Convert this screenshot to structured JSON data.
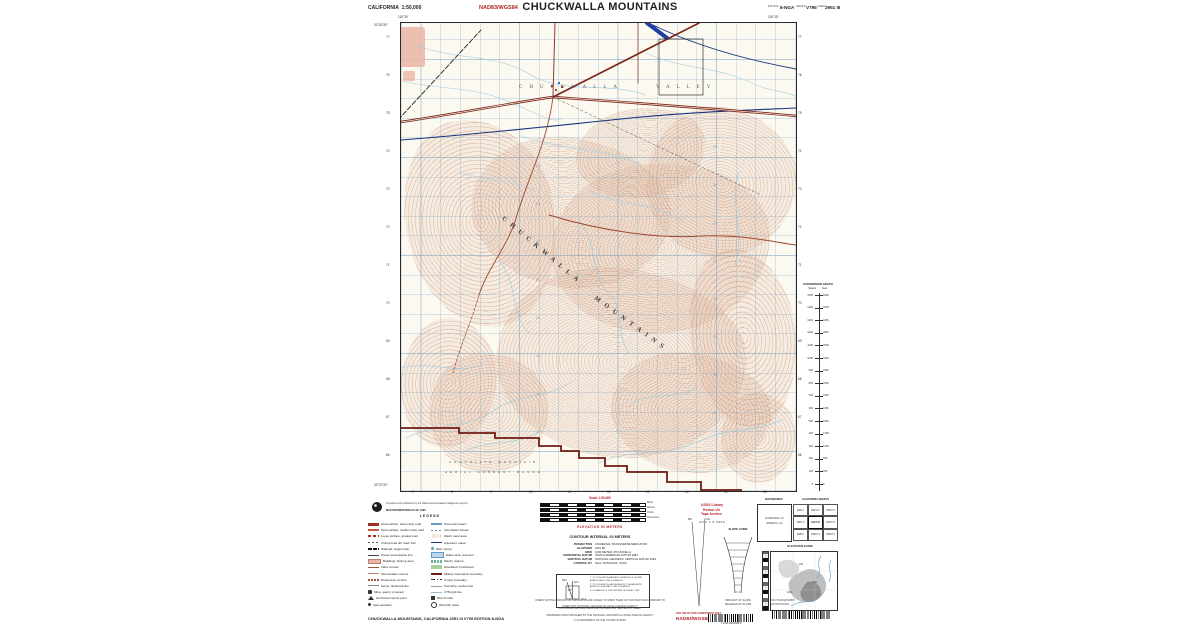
{
  "colors": {
    "accent_red": "#b01f24",
    "road": "#8a3a28",
    "contour": "#b07a5e",
    "water": "#9cc7de",
    "grid_line": "#9db9cc",
    "boundary": "#6e1d12"
  },
  "header": {
    "region": "CALIFORNIA",
    "scale": "1:50,000",
    "datum": "NAD83/WGS84",
    "title": "CHUCKWALLA MOUNTAINS",
    "edition_label": "EDITION",
    "edition": "8-NGA",
    "series_label": "SERIES",
    "series": "V795",
    "sheet_label": "SHEET",
    "sheet": "2951 III"
  },
  "map": {
    "labels": {
      "valley_1": "CHUCKWALLA",
      "valley_2": "VALLEY",
      "range_1": "CHUCKWALLA",
      "range_2": "MOUNTAINS",
      "range_s1": "CHOCOLATE MOUNTAIN",
      "range_s2": "AERIAL GUNNERY RANGE"
    },
    "corners": {
      "tl_lon": "115°30′",
      "tr_lon": "115°15′",
      "tl_lat": "33°52′30″",
      "bl_lat": "33°37′30″"
    },
    "grid": {
      "bottom": [
        "7",
        "8",
        "9",
        "10",
        "11",
        "12",
        "13",
        "14",
        "15",
        "16"
      ],
      "left": [
        "77",
        "76",
        "75",
        "74",
        "73",
        "72",
        "71",
        "70",
        "69",
        "68",
        "67",
        "66"
      ],
      "right": [
        "77",
        "76",
        "75",
        "74",
        "73",
        "72",
        "71",
        "70",
        "69",
        "68",
        "67",
        "66"
      ],
      "interior": [
        {
          "x": 135,
          "y": 142,
          "t": "24"
        },
        {
          "x": 135,
          "y": 180,
          "t": "23"
        },
        {
          "x": 135,
          "y": 218,
          "t": "22"
        },
        {
          "x": 135,
          "y": 256,
          "t": "21"
        },
        {
          "x": 135,
          "y": 294,
          "t": "20"
        },
        {
          "x": 135,
          "y": 332,
          "t": "19"
        },
        {
          "x": 135,
          "y": 370,
          "t": "18"
        },
        {
          "x": 135,
          "y": 408,
          "t": "17"
        },
        {
          "x": 312,
          "y": 123,
          "t": "25"
        },
        {
          "x": 312,
          "y": 161,
          "t": "24"
        },
        {
          "x": 312,
          "y": 199,
          "t": "23"
        },
        {
          "x": 312,
          "y": 237,
          "t": "22"
        },
        {
          "x": 312,
          "y": 275,
          "t": "21"
        },
        {
          "x": 312,
          "y": 313,
          "t": "20"
        },
        {
          "x": 312,
          "y": 351,
          "t": "19"
        },
        {
          "x": 312,
          "y": 389,
          "t": "18"
        }
      ]
    }
  },
  "conversion": {
    "title": "CONVERSION GRAPH",
    "col_m": "Meters",
    "col_f": "Feet",
    "meters": [
      "1500",
      "1400",
      "1300",
      "1200",
      "1100",
      "1000",
      "900",
      "800",
      "700",
      "600",
      "500",
      "400",
      "300",
      "200",
      "100",
      "0"
    ],
    "feet": [
      "4900",
      "4600",
      "4250",
      "3950",
      "3600",
      "3300",
      "2950",
      "2600",
      "2300",
      "1950",
      "1650",
      "1300",
      "1000",
      "650",
      "350",
      "0"
    ]
  },
  "legend": {
    "credit1": "Prepared and published by the National Geospatial-Intelligence Agency",
    "credit2": "MAP INFORMATION AS OF 1995",
    "title": "LEGEND",
    "left": [
      {
        "t": "Hard surface, heavy duty road",
        "s": "sw-road2"
      },
      {
        "t": "Hard surface, medium duty road",
        "s": "sw-road1"
      },
      {
        "t": "Loose surface, graded road",
        "s": "sw-roadl"
      },
      {
        "t": "Unimproved dirt road; trail",
        "s": "sw-dash"
      },
      {
        "t": "Railroad: single track",
        "s": "sw-rail"
      },
      {
        "t": "Power transmission line",
        "s": "sw-power"
      },
      {
        "t": "Buildings; built-up area",
        "s": "sw-pink"
      },
      {
        "t": "Index contour",
        "s": "sw-cbrown2"
      },
      {
        "t": "Intermediate contour",
        "s": "sw-cbrown1"
      },
      {
        "t": "Depression contour",
        "s": "sw-cbrownd"
      },
      {
        "t": "Fence; landmark line",
        "s": "sw-gray"
      },
      {
        "t": "Mine; quarry; prospect",
        "s": "sw-x"
      },
      {
        "t": "Horizontal control point",
        "s": "sw-tri"
      },
      {
        "t": "Spot elevation",
        "s": "sw-dot"
      }
    ],
    "right": [
      {
        "t": "Perennial stream",
        "s": "sw-blue"
      },
      {
        "t": "Intermittent stream",
        "s": "sw-blued"
      },
      {
        "t": "Wash; sand area",
        "s": "sw-sand"
      },
      {
        "t": "Aqueduct; canal",
        "s": "sw-bluet"
      },
      {
        "t": "Well; spring",
        "s": "sw-dotb"
      },
      {
        "t": "Water tank; reservoir",
        "s": "sw-bluebox"
      },
      {
        "t": "Marsh; swamp",
        "s": "sw-marsh"
      },
      {
        "t": "Woodland; brushwood",
        "s": "sw-green"
      },
      {
        "t": "Military reservation boundary",
        "s": "sw-bdry"
      },
      {
        "t": "County boundary",
        "s": "sw-bdry2"
      },
      {
        "t": "Township, section line",
        "s": "sw-sect"
      },
      {
        "t": "UTM grid line",
        "s": "sw-grid"
      },
      {
        "t": "Bench mark",
        "s": "sw-bm"
      },
      {
        "t": "Windmill; tower",
        "s": "sw-wind"
      }
    ]
  },
  "scaleblock": {
    "scale_label": "Scale 1:50,000",
    "bars": [
      "Miles",
      "Meters",
      "Yards",
      "Kilometers"
    ],
    "elevation": "ELEVATION IN METERS",
    "contour": "CONTOUR INTERVAL 20 METERS"
  },
  "specs": [
    {
      "k": "PROJECTION",
      "v": "UNIVERSAL TRANSVERSE MERCATOR"
    },
    {
      "k": "ELLIPSOID",
      "v": "GRS 80"
    },
    {
      "k": "GRID",
      "v": "1000-METER UTM ZONE 11"
    },
    {
      "k": "HORIZONTAL DATUM",
      "v": "NORTH AMERICAN DATUM 1983"
    },
    {
      "k": "VERTICAL DATUM",
      "v": "NATIONAL GEODETIC VERTICAL DATUM 1929"
    },
    {
      "k": "CONTROL BY",
      "v": "NGA, NOS/NOAA, USGS"
    }
  ],
  "declination": {
    "gn": "GN",
    "mn": "MN",
    "angle": "13°",
    "mils": "0°14′",
    "notes": [
      "1. TO CONVERT A MAGNETIC AZIMUTH TO A GRID AZIMUTH ADD THE G-M ANGLE",
      "2. TO CONVERT A GRID AZIMUTH TO A MAGNETIC AZIMUTH SUBTRACT THE G-M ANGLE",
      "3. G-M ANGLE IS FOR CENTER OF SHEET, 1995"
    ],
    "footnote": "G-M ANGLE AND GRID DECLINATION ARE FOR CENTER OF SHEET"
  },
  "slope": {
    "title": "SLOPE GUIDE",
    "note1": "PERCENT OF SLOPE",
    "note2": "DEGREES OF SLOPE"
  },
  "stamp": {
    "l1": "USGS Library",
    "l2": "Reston VA",
    "l3": "Tape Archive",
    "date": "AUG 1 9 2003"
  },
  "boundaries": {
    "title": "BOUNDARIES",
    "l1": "RIVERSIDE CO",
    "l2": "IMPERIAL CO"
  },
  "sheets": {
    "title": "CALIFORNIA SHEETS",
    "cells": [
      "2851 I",
      "2951 IV",
      "3051 IV",
      "2851 II",
      "2951 III",
      "3051 III",
      "2850 I",
      "2950 IV",
      "3050 IV"
    ]
  },
  "elevguide": {
    "title": "ELEVATION GUIDE",
    "spots": [
      {
        "x": 16,
        "y": 40,
        "t": "1200"
      },
      {
        "x": 42,
        "y": 30,
        "t": "800"
      },
      {
        "x": 28,
        "y": 12,
        "t": "400"
      }
    ]
  },
  "notes": {
    "copy1": "USERS NOTING ERRORS OR OMISSIONS ARE URGED TO MARK THEM ON THIS MAP AND FORWARD TO",
    "copy2": "DIRECTOR, NATIONAL GEOSPATIAL-INTELLIGENCE AGENCY"
  },
  "footer": {
    "left": "CHUCKWALLA MOUNTAINS, CALIFORNIA    2951 III    V795    EDITION 8-NGA",
    "center1": "PREPARED AND PUBLISHED BY THE NATIONAL GEOSPATIAL-INTELLIGENCE AGENCY",
    "center2": "© GOVERNMENT OF THE UNITED STATES",
    "right_red_small": "FOR USE BY DOD COMPONENTS ONLY",
    "right_red": "NAD83/WGS84",
    "barcode_text": "1 1018 0051068 3",
    "right_block1": "NSN 7643014519876",
    "right_block2": "EDITION 8-NGA"
  }
}
